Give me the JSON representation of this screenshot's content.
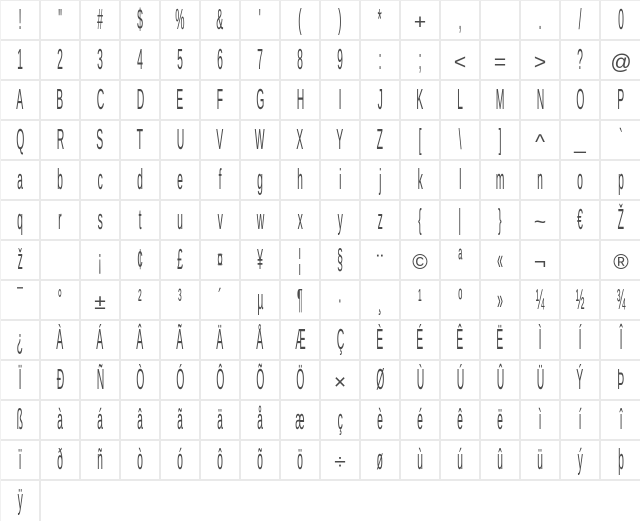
{
  "app": {
    "name": "font-character-map",
    "description_visible": false
  },
  "colors": {
    "background": "#ffffff",
    "grid_line": "#e9e9e9",
    "glyph": "#4a4a4a"
  },
  "grid": {
    "columns": 16,
    "row_count": 13,
    "cell_size_px": 40,
    "rows": [
      [
        "!",
        "\"",
        "#",
        "$",
        "%",
        "&",
        "'",
        "(",
        ")",
        "*",
        "+",
        ",",
        "",
        ".",
        "/",
        "0"
      ],
      [
        "1",
        "2",
        "3",
        "4",
        "5",
        "6",
        "7",
        "8",
        "9",
        ":",
        ";",
        "<",
        "=",
        ">",
        "?",
        "@"
      ],
      [
        "A",
        "B",
        "C",
        "D",
        "E",
        "F",
        "G",
        "H",
        "I",
        "J",
        "K",
        "L",
        "M",
        "N",
        "O",
        "P"
      ],
      [
        "Q",
        "R",
        "S",
        "T",
        "U",
        "V",
        "W",
        "X",
        "Y",
        "Z",
        "[",
        "\\",
        "]",
        "^",
        "_",
        "`"
      ],
      [
        "a",
        "b",
        "c",
        "d",
        "e",
        "f",
        "g",
        "h",
        "i",
        "j",
        "k",
        "l",
        "m",
        "n",
        "o",
        "p"
      ],
      [
        "q",
        "r",
        "s",
        "t",
        "u",
        "v",
        "w",
        "x",
        "y",
        "z",
        "{",
        "|",
        "}",
        "~",
        "€",
        "Ž"
      ],
      [
        "ž",
        "",
        "¡",
        "¢",
        "£",
        "¤",
        "¥",
        "¦",
        "§",
        "¨",
        "©",
        "ª",
        "«",
        "¬",
        "",
        "®"
      ],
      [
        "¯",
        "°",
        "±",
        "²",
        "³",
        "´",
        "µ",
        "¶",
        "·",
        "¸",
        "¹",
        "º",
        "»",
        "¼",
        "½",
        "¾"
      ],
      [
        "¿",
        "À",
        "Á",
        "Â",
        "Ã",
        "Ä",
        "Å",
        "Æ",
        "Ç",
        "È",
        "É",
        "Ê",
        "Ë",
        "Ì",
        "Í",
        "Î"
      ],
      [
        "Ï",
        "Ð",
        "Ñ",
        "Ò",
        "Ó",
        "Ô",
        "Õ",
        "Ö",
        "×",
        "Ø",
        "Ù",
        "Ú",
        "Û",
        "Ü",
        "Ý",
        "Þ"
      ],
      [
        "ß",
        "à",
        "á",
        "â",
        "ã",
        "ä",
        "å",
        "æ",
        "ç",
        "è",
        "é",
        "ê",
        "ë",
        "ì",
        "í",
        "î"
      ],
      [
        "ï",
        "ð",
        "ñ",
        "ò",
        "ó",
        "ô",
        "õ",
        "ö",
        "÷",
        "ø",
        "ù",
        "ú",
        "û",
        "ü",
        "ý",
        "þ"
      ],
      [
        "ÿ",
        "",
        "",
        "",
        "",
        "",
        "",
        "",
        "",
        "",
        "",
        "",
        "",
        "",
        "",
        ""
      ]
    ],
    "wide_glyphs": [
      "@",
      "+",
      "<",
      "=",
      ">",
      "^",
      "_",
      "~",
      "©",
      "®",
      "×",
      "÷",
      "±",
      "¬",
      "¨"
    ]
  }
}
